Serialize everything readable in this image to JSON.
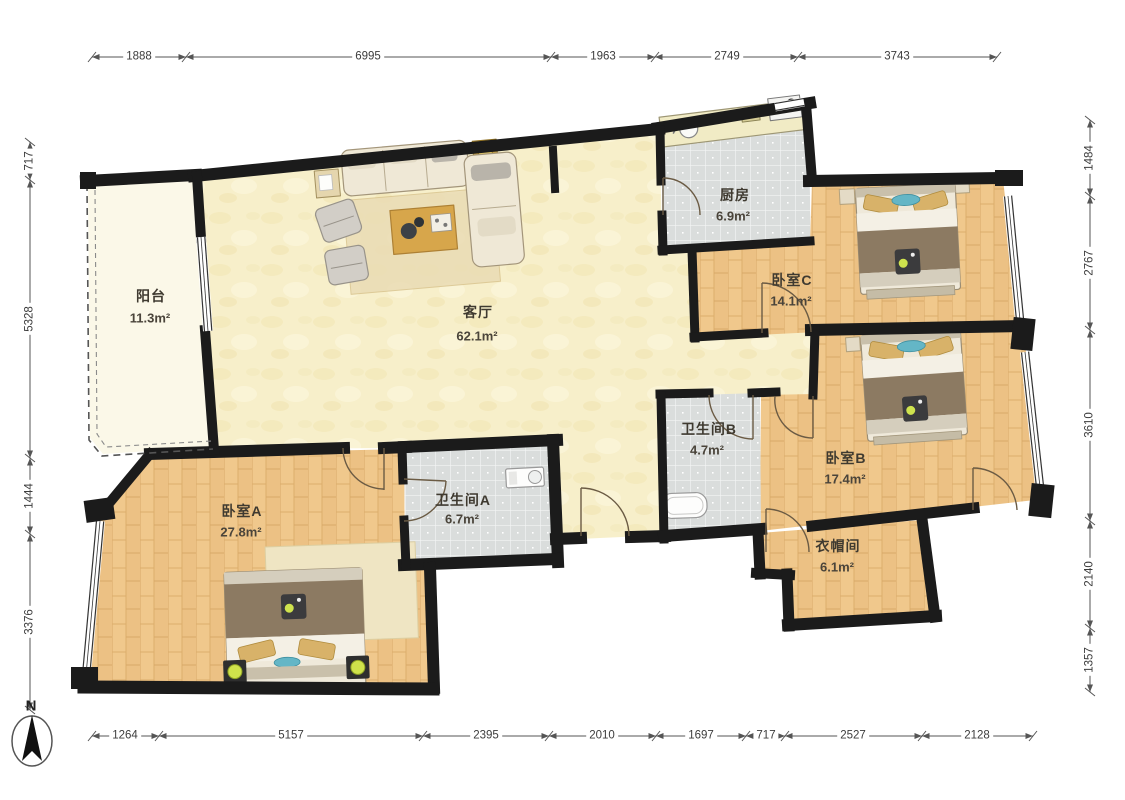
{
  "plan": {
    "compass_label": "N",
    "rooms": {
      "balcony": {
        "name": "阳台",
        "area": "11.3m²"
      },
      "living": {
        "name": "客厅",
        "area": "62.1m²"
      },
      "kitchen": {
        "name": "厨房",
        "area": "6.9m²"
      },
      "bedroom_c": {
        "name": "卧室C",
        "area": "14.1m²"
      },
      "bedroom_b": {
        "name": "卧室B",
        "area": "17.4m²"
      },
      "bathroom_b": {
        "name": "卫生间B",
        "area": "4.7m²"
      },
      "bathroom_a": {
        "name": "卫生间A",
        "area": "6.7m²"
      },
      "bedroom_a": {
        "name": "卧室A",
        "area": "27.8m²"
      },
      "closet": {
        "name": "衣帽间",
        "area": "6.1m²"
      }
    },
    "dimensions_mm": {
      "top": [
        "1888",
        "6995",
        "1963",
        "2749",
        "3743"
      ],
      "bottom": [
        "1264",
        "5157",
        "2395",
        "2010",
        "1697",
        "717",
        "2527",
        "2128"
      ],
      "left": [
        "717",
        "5328",
        "1444",
        "3376"
      ],
      "right": [
        "1484",
        "2767",
        "3610",
        "2140",
        "1357"
      ]
    },
    "colors": {
      "wall": "#1b1b1b",
      "wood_floor": "#efc78b",
      "tile_floor": "#dadddc",
      "living_floor": "#f7efca",
      "balcony_floor": "#fbf8e8",
      "accent_teal": "#64b6c6",
      "dimension_text": "#3c3c3c"
    }
  }
}
